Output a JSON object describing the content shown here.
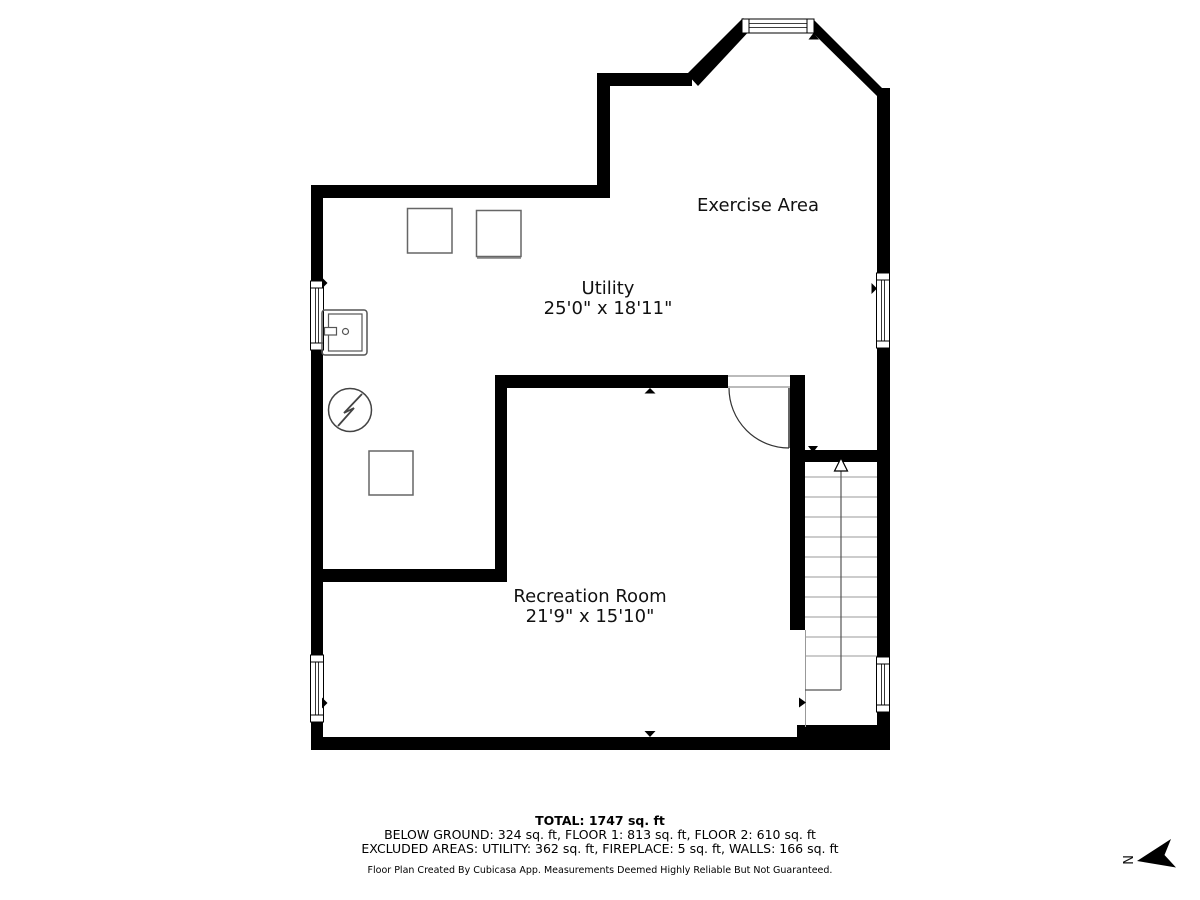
{
  "title": "Basement floor plan",
  "rooms": [
    {
      "id": "exercise-area",
      "name": "Exercise Area",
      "dimensions": ""
    },
    {
      "id": "utility",
      "name": "Utility",
      "dimensions": "25'0\" x 18'11\""
    },
    {
      "id": "recreation-room",
      "name": "Recreation Room",
      "dimensions": "21'9\" x 15'10\""
    }
  ],
  "summary": {
    "total": "TOTAL: 1747 sq. ft",
    "breakdown": "BELOW GROUND: 324 sq. ft, FLOOR 1: 813 sq. ft, FLOOR 2: 610 sq. ft",
    "excluded": "EXCLUDED AREAS: UTILITY: 362 sq. ft, FIREPLACE: 5 sq. ft, WALLS: 166 sq. ft",
    "disclaimer": "Floor Plan Created By Cubicasa App. Measurements Deemed Highly Reliable But Not Guaranteed."
  },
  "compass": {
    "label": "N"
  },
  "colors": {
    "walls": "#000000",
    "fixtures": "#555555",
    "steps": "#999999",
    "text": "#111111"
  }
}
